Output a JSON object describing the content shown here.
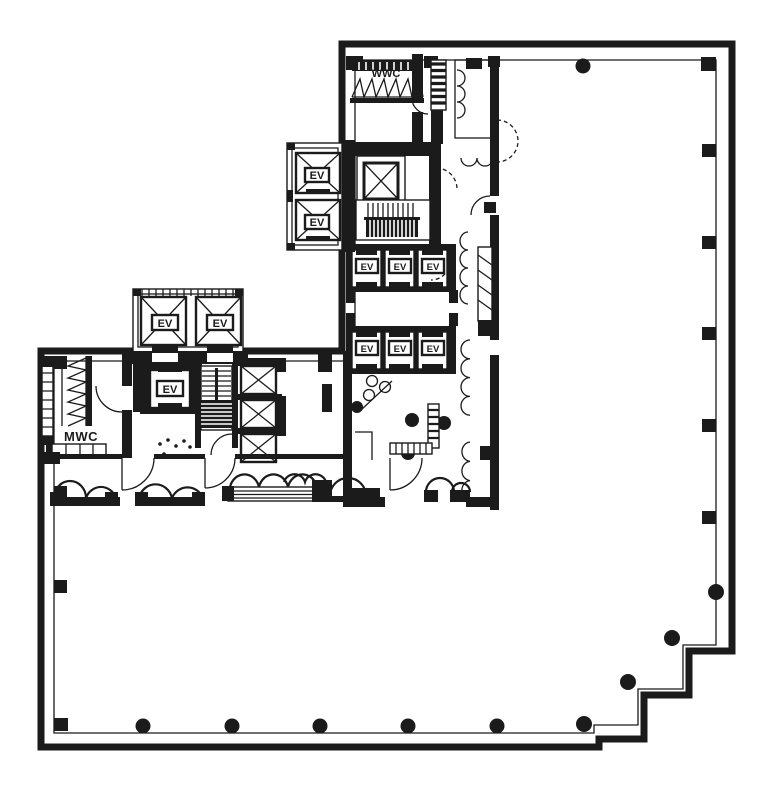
{
  "page": {
    "background": "#ffffff",
    "ink": "#1b1b1b",
    "type_note": "architectural floor plate drawing"
  },
  "labels": {
    "womens_washroom": "WWC",
    "mens_washroom": "MWC",
    "elevator": "EV"
  }
}
